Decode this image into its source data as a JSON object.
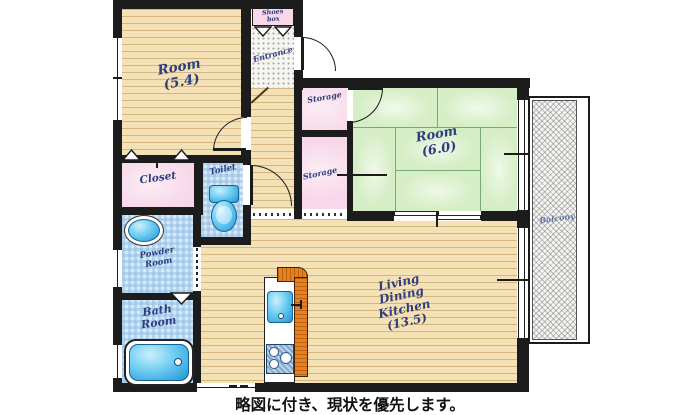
{
  "labels": {
    "room54_name": "Room",
    "room54_size": "(5.4)",
    "room60_name": "Room",
    "room60_size": "(6.0)",
    "ldk_l1": "Living",
    "ldk_l2": "Dining",
    "ldk_l3": "Kitchen",
    "ldk_l4": "(13.5)",
    "closet": "Closet",
    "toilet": "Toilet",
    "powder_l1": "Powder",
    "powder_l2": "Room",
    "bath_l1": "Bath",
    "bath_l2": "Room",
    "storage_top": "Storage",
    "storage_bottom": "Storage",
    "entrance": "Entrance",
    "shoes_l1": "Shoes",
    "shoes_l2": "box",
    "balcony": "Balcony",
    "caption": "略図に付き、現状を優先します。"
  },
  "colors": {
    "wall": "#1c1c1c",
    "wood_floor": "#f4e2b6",
    "tatami_green": "#d6eec6",
    "storage_pink": "#f7d7e9",
    "wetroom_blue": "#d7e9f6",
    "fixture_blue": "#4db8e8",
    "kitchen_orange": "#e8801f",
    "label_navy": "#2e3d7d"
  }
}
